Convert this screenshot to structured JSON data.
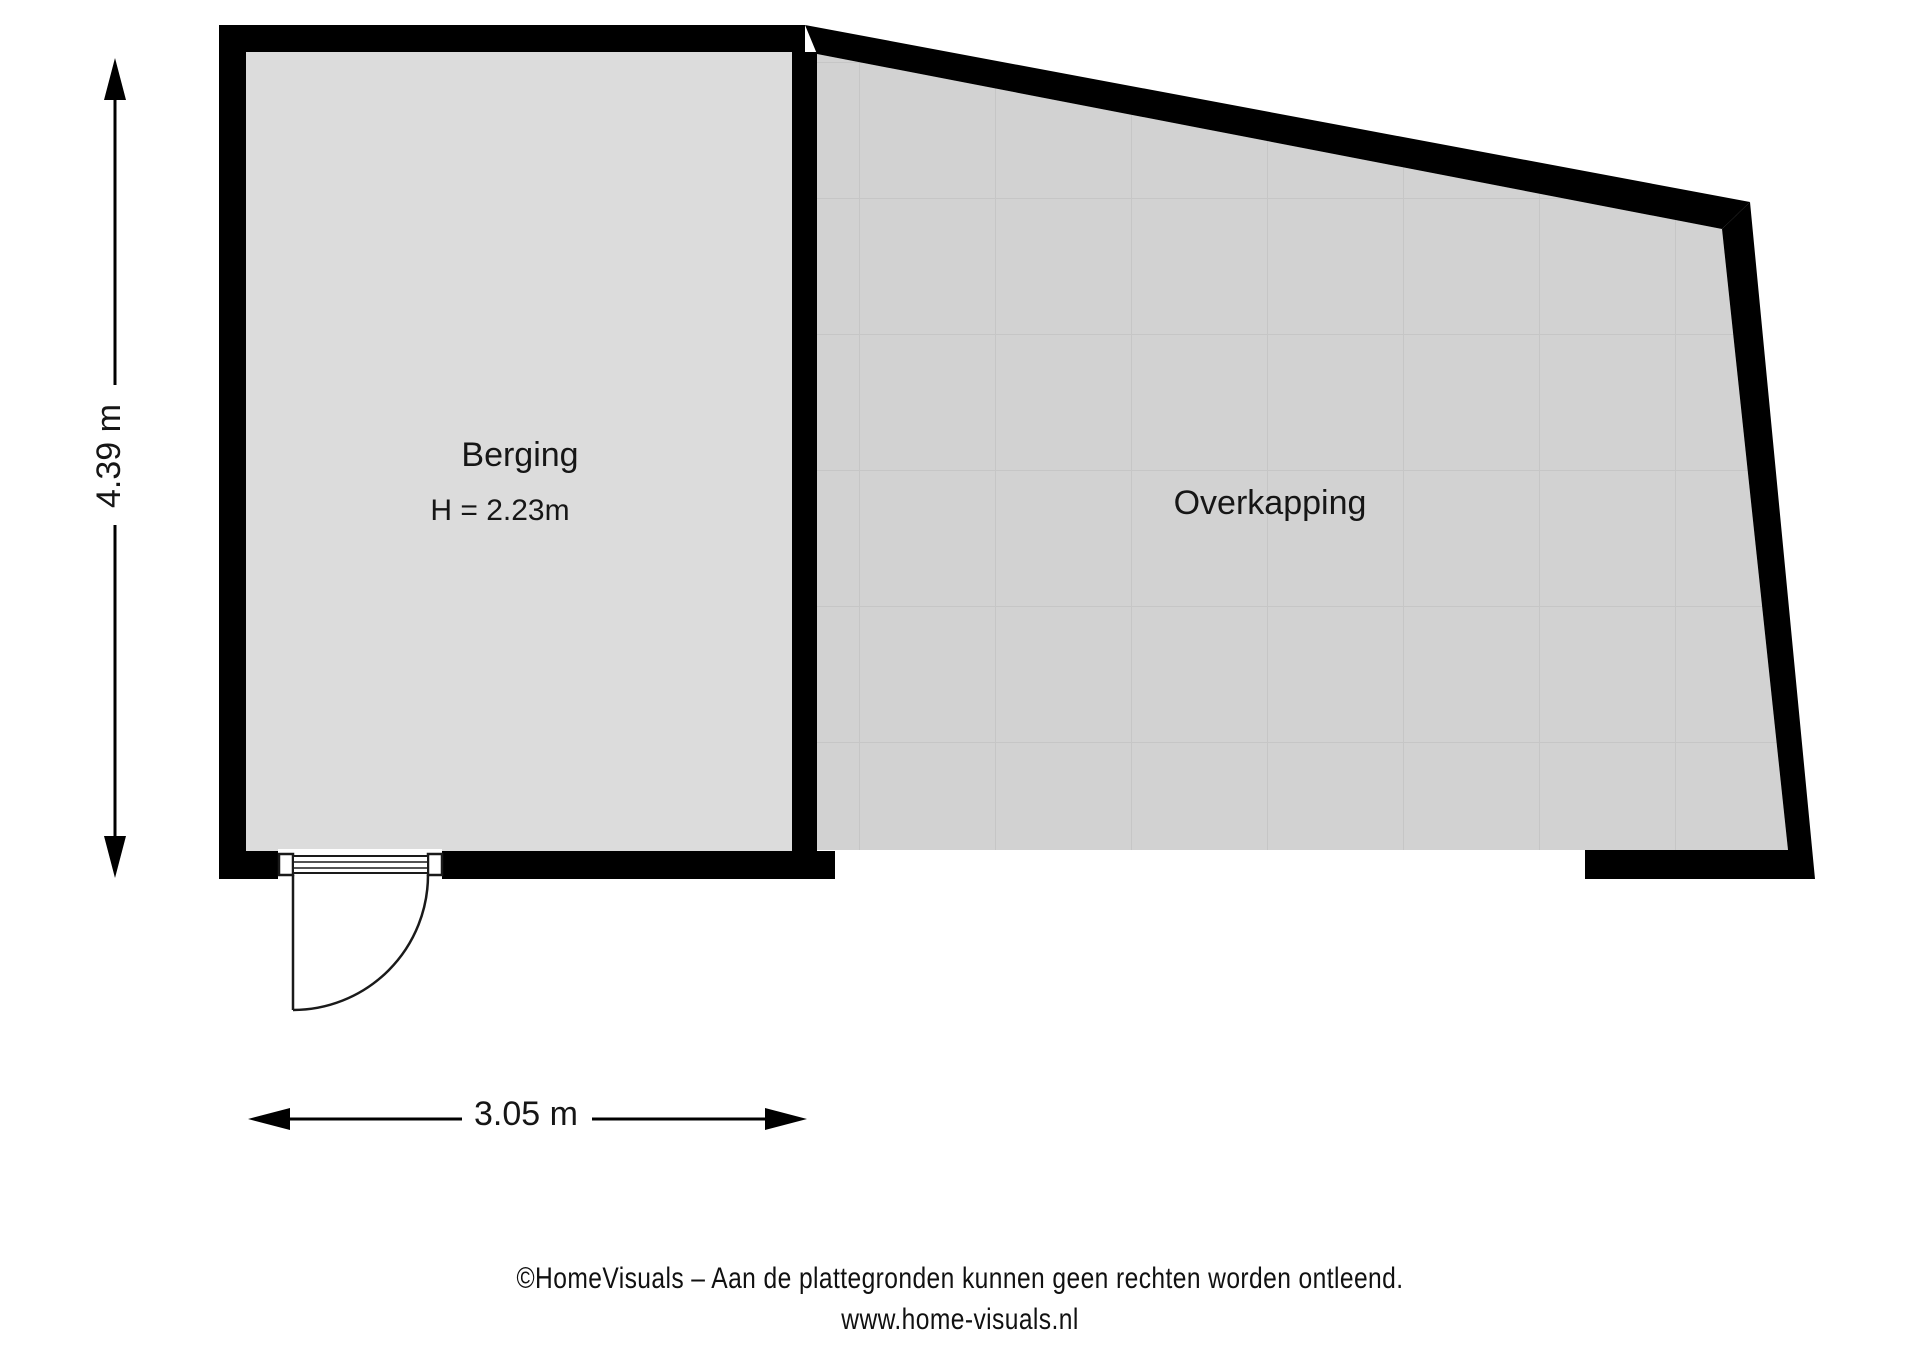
{
  "plan": {
    "rooms": [
      {
        "name": "Berging",
        "height_label": "H = 2.23m"
      },
      {
        "name": "Overkapping"
      }
    ],
    "dimensions": {
      "vertical": "4.39 m",
      "horizontal": "3.05 m"
    }
  },
  "footer": {
    "line1": "©HomeVisuals – Aan de plattegronden kunnen geen rechten worden ontleend.",
    "line2": "www.home-visuals.nl"
  },
  "colors": {
    "wall": "#000000",
    "berging_fill": "#dcdcdc",
    "overkapping_fill": "#d2d2d2",
    "tile_line": "#c6c6c6",
    "door_line": "#1a1a1a",
    "dimension_line": "#000000",
    "background": "#ffffff"
  }
}
